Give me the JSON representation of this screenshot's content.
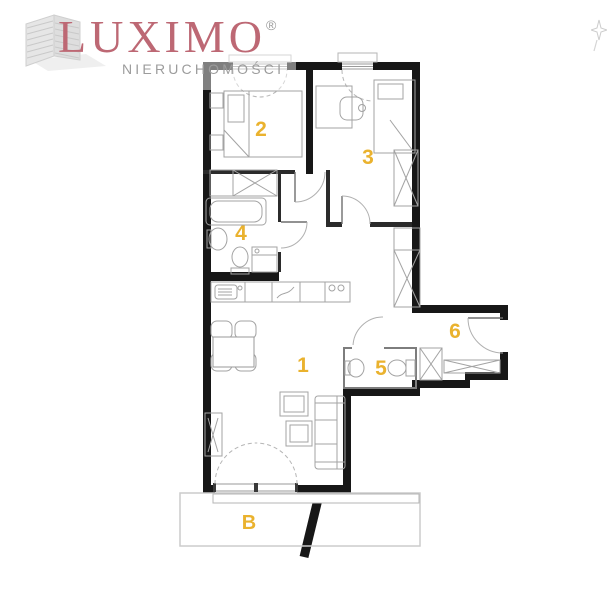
{
  "brand": {
    "name": "LUXIMO",
    "registered": "®",
    "subtitle": "NIERUCHOMOŚCI",
    "name_color": "#bd6874",
    "subtitle_color": "#9c9c9c",
    "logo_icon": "building-icon"
  },
  "floorplan": {
    "accent_color": "#eab22e",
    "wall_color": "#171717",
    "line_color": "#a3a3a3",
    "compass": "compass-icon",
    "rooms": [
      {
        "id": "living-room-kitchen",
        "label": "1"
      },
      {
        "id": "bedroom-1",
        "label": "2"
      },
      {
        "id": "bedroom-2",
        "label": "3"
      },
      {
        "id": "bathroom",
        "label": "4"
      },
      {
        "id": "wc",
        "label": "5"
      },
      {
        "id": "hall",
        "label": "6"
      },
      {
        "id": "balcony",
        "label": "B"
      }
    ]
  }
}
